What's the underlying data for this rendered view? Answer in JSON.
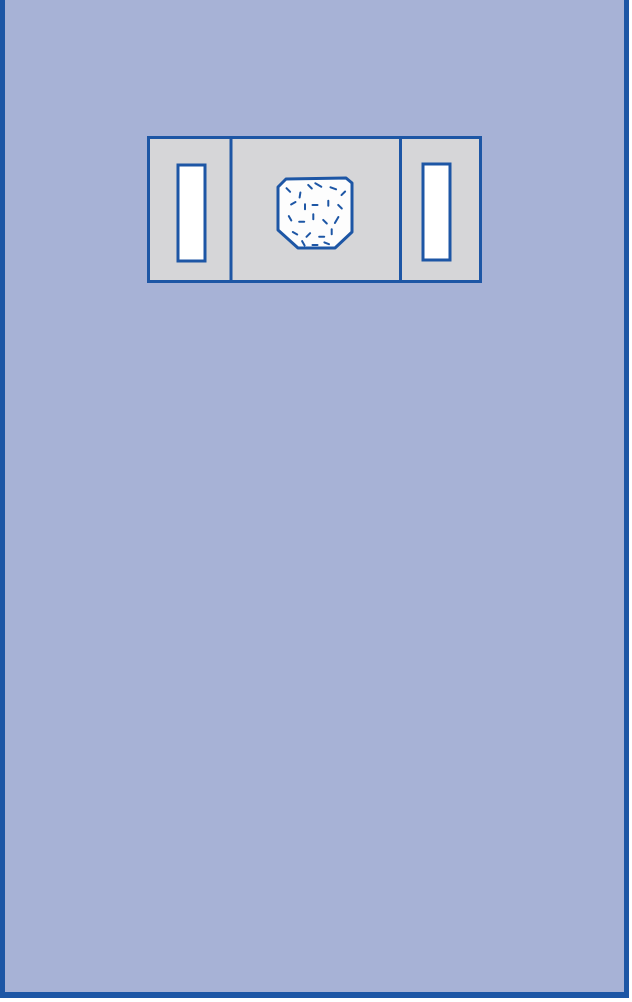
{
  "colors": {
    "page_background": "#a7b2d6",
    "page_border": "#1d56a5",
    "outside": "#ffffff",
    "panel_fill": "#d6d6d8",
    "outline": "#1d56a5",
    "slot_fill": "#ffffff",
    "pouch_fill": "#fdfdfd",
    "speckle": "#1d56a5"
  },
  "diagram": {
    "pouch_points": "131,51 139,43 199,42 205,47 205,96 188,112 151,112 131,94",
    "divider_left_x": 84,
    "divider_right_x": 253.5,
    "speckles": [
      {
        "x": 141.3,
        "y": 54.0,
        "a": 45,
        "len": 5
      },
      {
        "x": 153.0,
        "y": 59.0,
        "a": 100,
        "len": 5
      },
      {
        "x": 163.0,
        "y": 50.7,
        "a": 45,
        "len": 5
      },
      {
        "x": 171.3,
        "y": 49.0,
        "a": 30,
        "len": 7
      },
      {
        "x": 186.3,
        "y": 52.3,
        "a": 20,
        "len": 6
      },
      {
        "x": 196.3,
        "y": 57.3,
        "a": -45,
        "len": 5
      },
      {
        "x": 146.3,
        "y": 67.3,
        "a": -30,
        "len": 5
      },
      {
        "x": 158.0,
        "y": 70.7,
        "a": 90,
        "len": 5
      },
      {
        "x": 168.0,
        "y": 69.0,
        "a": 0,
        "len": 5
      },
      {
        "x": 181.3,
        "y": 67.3,
        "a": 90,
        "len": 5
      },
      {
        "x": 193.0,
        "y": 70.7,
        "a": 45,
        "len": 5
      },
      {
        "x": 143.0,
        "y": 82.3,
        "a": 60,
        "len": 5
      },
      {
        "x": 154.7,
        "y": 85.7,
        "a": 0,
        "len": 5
      },
      {
        "x": 166.3,
        "y": 80.7,
        "a": 90,
        "len": 5
      },
      {
        "x": 178.0,
        "y": 85.7,
        "a": 45,
        "len": 5
      },
      {
        "x": 189.7,
        "y": 84.0,
        "a": -60,
        "len": 7
      },
      {
        "x": 148.0,
        "y": 97.3,
        "a": 30,
        "len": 5
      },
      {
        "x": 161.3,
        "y": 99.0,
        "a": -45,
        "len": 5
      },
      {
        "x": 174.7,
        "y": 100.7,
        "a": 0,
        "len": 5
      },
      {
        "x": 184.7,
        "y": 95.7,
        "a": 90,
        "len": 5
      },
      {
        "x": 168.0,
        "y": 109.0,
        "a": 0,
        "len": 5
      },
      {
        "x": 156.3,
        "y": 107.3,
        "a": 60,
        "len": 5
      },
      {
        "x": 179.7,
        "y": 107.3,
        "a": 20,
        "len": 5
      }
    ]
  }
}
